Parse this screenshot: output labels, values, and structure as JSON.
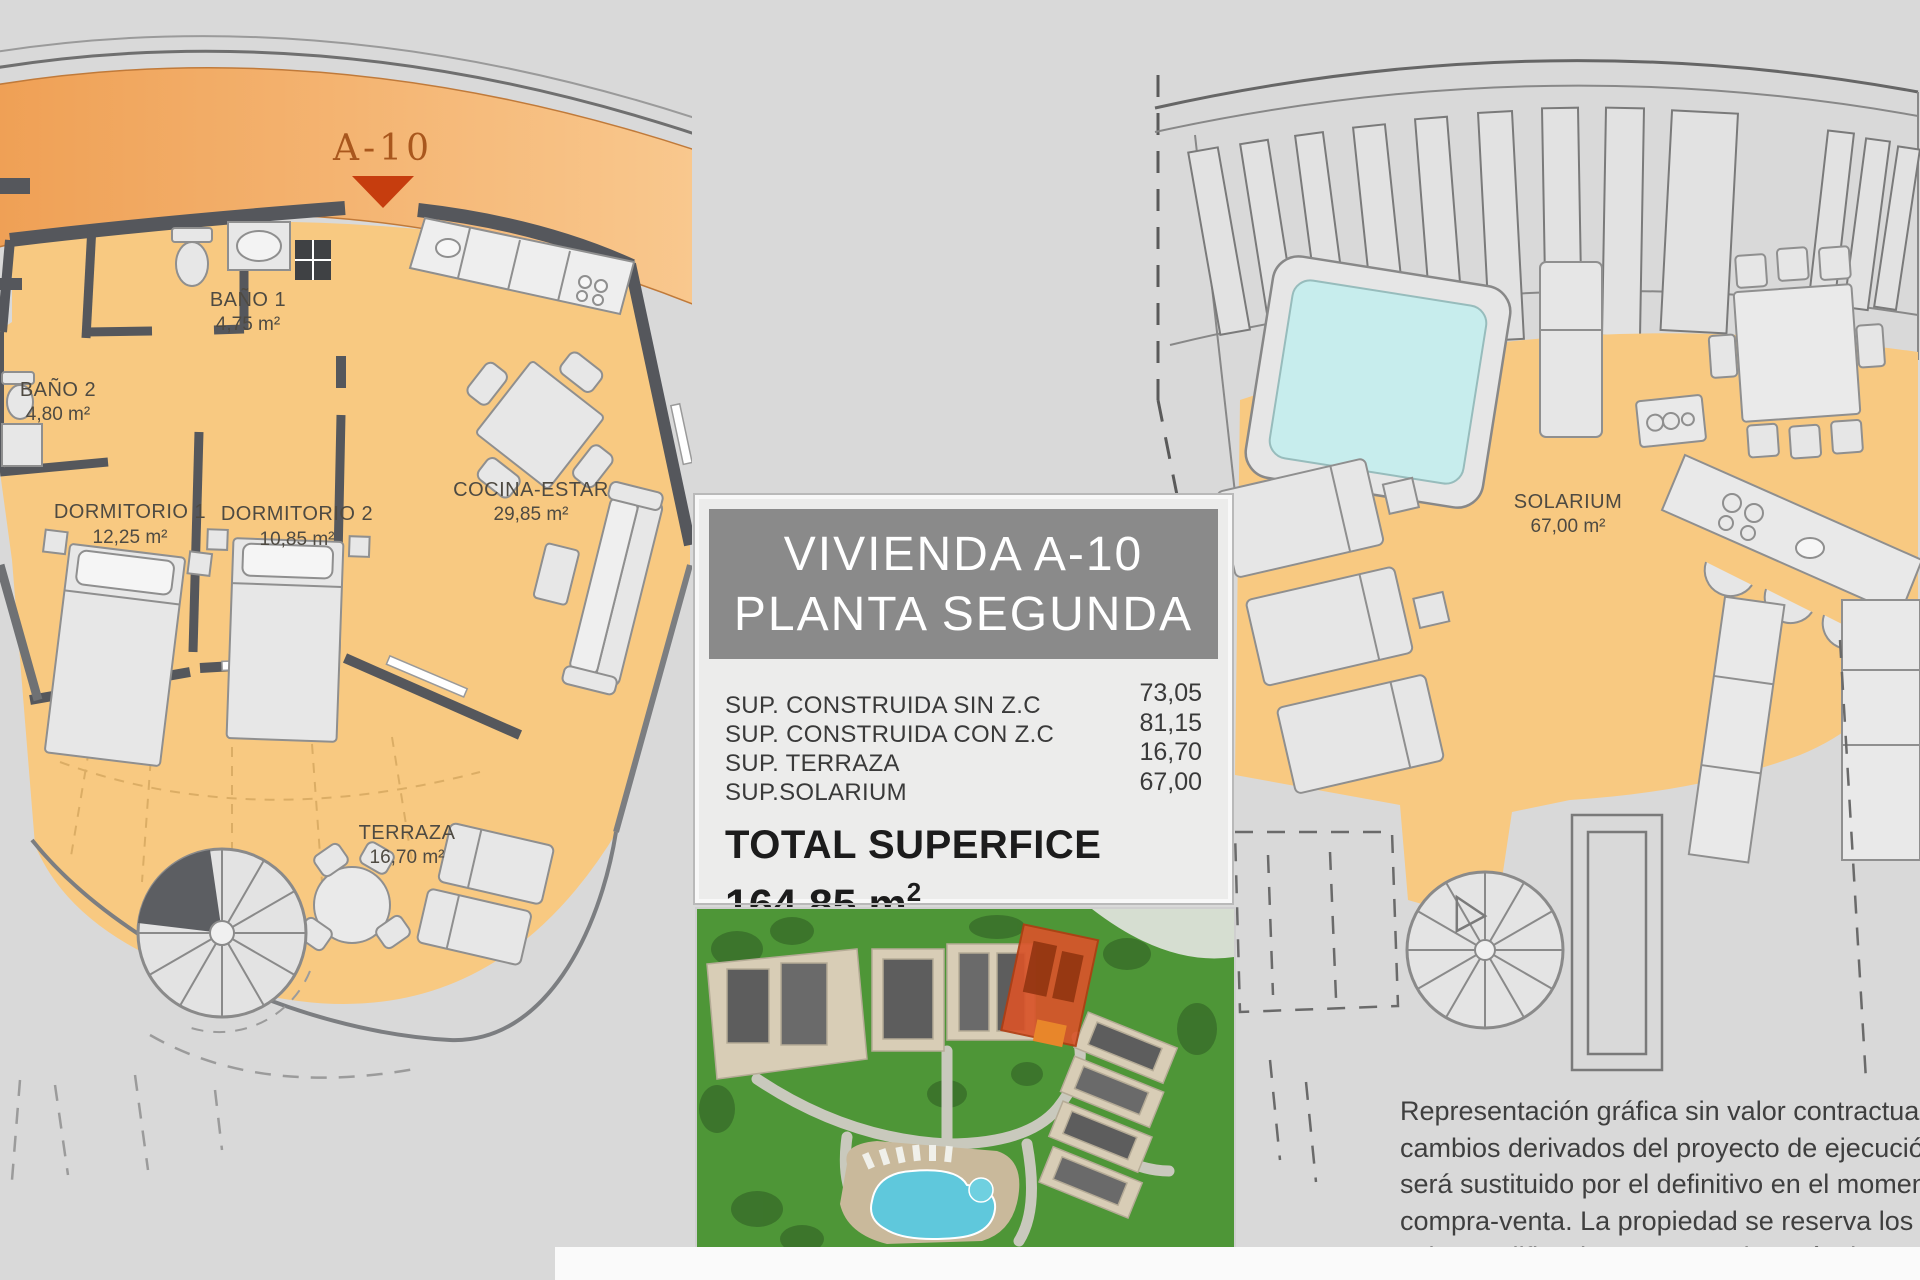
{
  "sheet": {
    "left_plan": {
      "unit_marker": "A-10",
      "rooms": [
        {
          "name": "BAÑO 1",
          "area": "4,75 m²"
        },
        {
          "name": "BAÑO 2",
          "area": "4,80 m²"
        },
        {
          "name": "DORMITORIO 1",
          "area": "12,25 m²"
        },
        {
          "name": "DORMITORIO 2",
          "area": "10,85 m²"
        },
        {
          "name": "COCINA-ESTAR",
          "area": "29,85 m²"
        },
        {
          "name": "TERRAZA",
          "area": "16,70 m²"
        }
      ]
    },
    "right_plan": {
      "room": {
        "name": "SOLARIUM",
        "area": "67,00 m²"
      }
    },
    "info_panel": {
      "title_line1": "VIVIENDA A-10",
      "title_line2": "PLANTA SEGUNDA",
      "measurements": [
        {
          "label": "SUP. CONSTRUIDA SIN Z.C",
          "value": "73,05"
        },
        {
          "label": "SUP. CONSTRUIDA CON Z.C",
          "value": "81,15"
        },
        {
          "label": "SUP. TERRAZA",
          "value": "16,70"
        },
        {
          "label": "SUP.SOLARIUM",
          "value": "67,00"
        }
      ],
      "total_label": "TOTAL SUPERFICE",
      "total_value": "164,85 m",
      "total_superscript": "2"
    },
    "disclaimer": {
      "lines": [
        "Representación gráfica sin valor contractual sujeta a",
        "cambios derivados del proyecto de ejecución y en cualq",
        "será sustituido por el definitivo en el momento de la fi",
        "compra-venta. La propiedad se reserva los derechos a",
        "cabo modificaciones por motivos técnicos y cump",
        "normativa vigente."
      ]
    },
    "colors": {
      "floor_orange": "#f8c981",
      "band_orange_dark": "#efa055",
      "band_orange_light": "#f9c88e",
      "wall_gray": "#55575c",
      "marker_red": "#c63d0e",
      "marker_text": "#a9571d",
      "title_box_gray": "#8a8a8a",
      "pool_cyan": "#c7eded",
      "highlight_red": "#d8542a"
    }
  }
}
